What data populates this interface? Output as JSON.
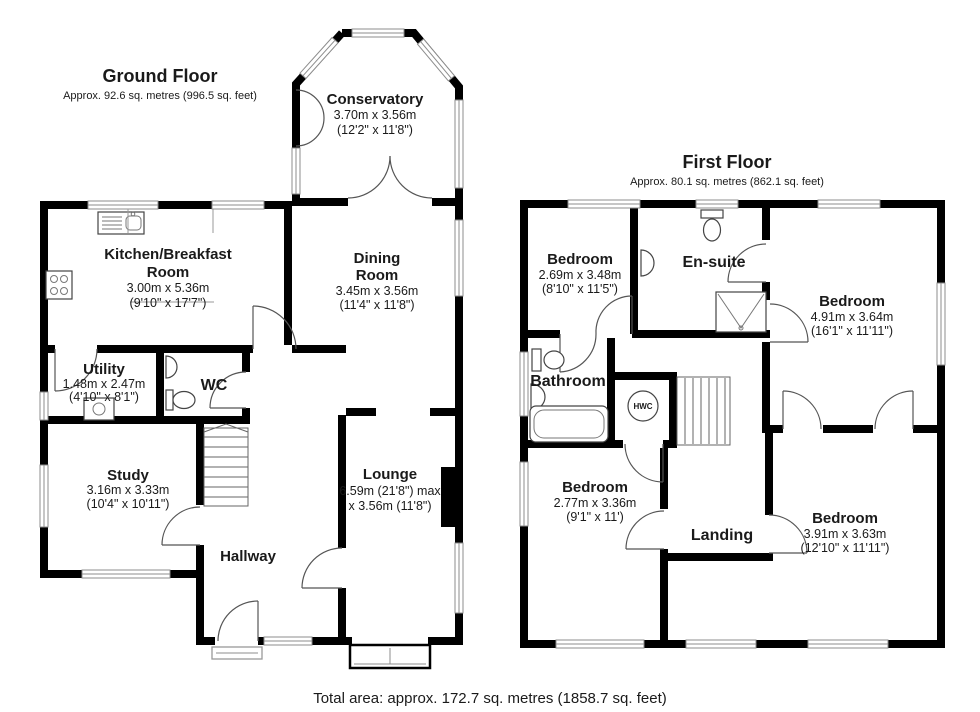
{
  "ground_floor": {
    "title": "Ground Floor",
    "area": "Approx. 92.6 sq. metres (996.5 sq. feet)",
    "rooms": {
      "conservatory": {
        "name": "Conservatory",
        "dims_m": "3.70m x 3.56m",
        "dims_ft": "(12'2\" x 11'8\")"
      },
      "kitchen": {
        "name_l1": "Kitchen/Breakfast",
        "name_l2": "Room",
        "dims_m": "3.00m x 5.36m",
        "dims_ft": "(9'10\" x 17'7\")"
      },
      "dining": {
        "name_l1": "Dining",
        "name_l2": "Room",
        "dims_m": "3.45m x 3.56m",
        "dims_ft": "(11'4\" x 11'8\")"
      },
      "utility": {
        "name": "Utility",
        "dims_m": "1.48m x 2.47m",
        "dims_ft": "(4'10\" x 8'1\")"
      },
      "wc": {
        "name": "WC"
      },
      "study": {
        "name": "Study",
        "dims_m": "3.16m x 3.33m",
        "dims_ft": "(10'4\" x 10'11\")"
      },
      "lounge": {
        "name": "Lounge",
        "dims_l1": "6.59m (21'8\") max",
        "dims_l2": "x 3.56m (11'8\")"
      },
      "hallway": {
        "name": "Hallway"
      }
    }
  },
  "first_floor": {
    "title": "First Floor",
    "area": "Approx. 80.1 sq. metres (862.1 sq. feet)",
    "rooms": {
      "bedroom_front": {
        "name": "Bedroom",
        "dims_m": "2.69m x 3.48m",
        "dims_ft": "(8'10\" x 11'5\")"
      },
      "ensuite": {
        "name": "En-suite"
      },
      "bedroom_main": {
        "name": "Bedroom",
        "dims_m": "4.91m x 3.64m",
        "dims_ft": "(16'1\" x 11'11\")"
      },
      "bathroom": {
        "name": "Bathroom"
      },
      "hwc": {
        "label": "HWC"
      },
      "bedroom_side": {
        "name": "Bedroom",
        "dims_m": "2.77m x 3.36m",
        "dims_ft": "(9'1\" x 11')"
      },
      "landing": {
        "name": "Landing"
      },
      "bedroom_rear": {
        "name": "Bedroom",
        "dims_m": "3.91m x 3.63m",
        "dims_ft": "(12'10\" x 11'11\")"
      }
    }
  },
  "footer": {
    "total_area": "Total area: approx. 172.7 sq. metres (1858.7 sq. feet)"
  },
  "colors": {
    "wall": "#000000",
    "text": "#1a1a1a",
    "window_frame": "#8c8c8c",
    "fixture_line": "#444444",
    "background": "#ffffff"
  }
}
